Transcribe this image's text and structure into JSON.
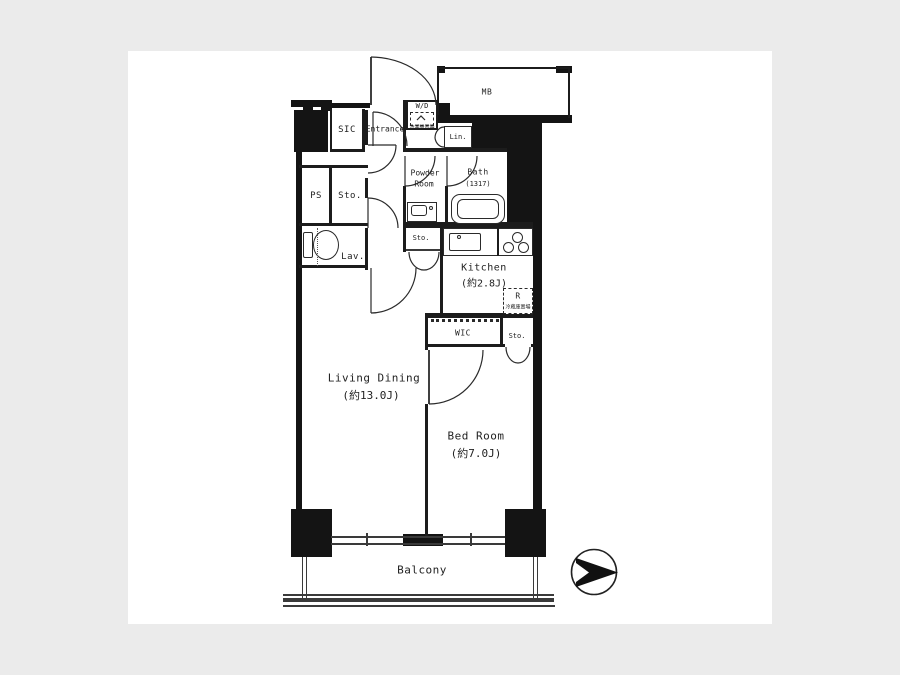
{
  "page": {
    "background": "#ebebeb",
    "canvas_background": "#ffffff",
    "ink_color": "#1a1a1a"
  },
  "plan": {
    "rooms": {
      "living_dining": {
        "name": "Living Dining",
        "size": "(約13.0J)"
      },
      "bed_room": {
        "name": "Bed Room",
        "size": "(約7.0J)"
      },
      "kitchen": {
        "name": "Kitchen",
        "size": "(約2.8J)"
      },
      "bath": {
        "name": "Bath",
        "size": "(1317)"
      },
      "powder_room": {
        "name_line1": "Powder",
        "name_line2": "Room"
      },
      "balcony": {
        "name": "Balcony"
      },
      "entrance": {
        "name": "Entrance"
      }
    },
    "labels": {
      "mb": "MB",
      "wd": "W/D",
      "wd_note": "洗濯機置場",
      "lin": "Lin.",
      "sic": "SIC",
      "ps": "PS",
      "sto": "Sto.",
      "lav": "Lav.",
      "wic": "WIC",
      "refrigerator": "R",
      "refrigerator_note": "冷蔵庫置場"
    },
    "icons": {
      "compass": "compass-arrow-icon",
      "toilet": "toilet-icon",
      "bathtub": "bathtub-icon",
      "vanity": "vanity-sink-icon",
      "kitchen_sink": "kitchen-sink-icon",
      "stove": "stove-burners-icon",
      "hanger_rail": "hanger-rail-dots"
    }
  }
}
